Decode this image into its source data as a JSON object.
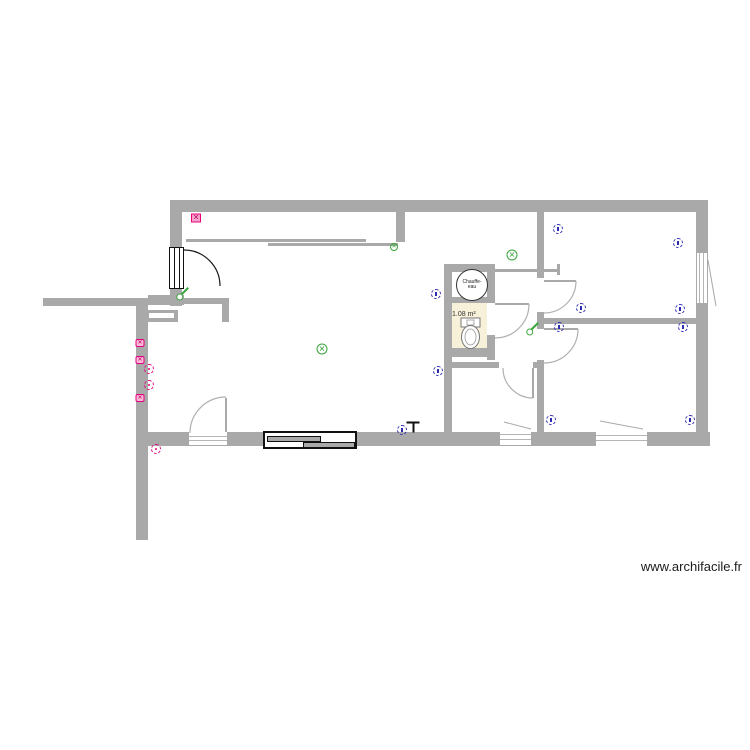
{
  "watermark": {
    "text": "www.archifacile.fr"
  },
  "labels": {
    "water_heater": "Chauffe-eau",
    "wc_area": "1.08 m²"
  },
  "colors": {
    "wall_gray": "#a9a9a9",
    "door_arc_gray": "#b0b0b0",
    "entry_door_black": "#111111",
    "outlet_pink": "#e5007d",
    "outlet_blue": "#2b2bb4",
    "light_green": "#3aa53a",
    "wc_floor_beige": "#f8f1da"
  },
  "symbols": [
    {
      "type": "socket-grid-pink",
      "x": 196,
      "y": 218
    },
    {
      "type": "outlet-pink",
      "x": 140,
      "y": 343
    },
    {
      "type": "outlet-pink",
      "x": 140,
      "y": 360
    },
    {
      "type": "outlet-pink-dashed",
      "x": 149,
      "y": 369
    },
    {
      "type": "outlet-pink-dashed",
      "x": 149,
      "y": 385
    },
    {
      "type": "outlet-pink",
      "x": 140,
      "y": 398
    },
    {
      "type": "outlet-pink-dashed",
      "x": 156,
      "y": 449
    },
    {
      "type": "outlet-blue",
      "x": 558,
      "y": 229
    },
    {
      "type": "outlet-blue",
      "x": 678,
      "y": 243
    },
    {
      "type": "outlet-blue",
      "x": 436,
      "y": 294
    },
    {
      "type": "outlet-blue",
      "x": 581,
      "y": 308
    },
    {
      "type": "outlet-blue",
      "x": 680,
      "y": 309
    },
    {
      "type": "outlet-blue",
      "x": 559,
      "y": 327
    },
    {
      "type": "outlet-blue",
      "x": 683,
      "y": 327
    },
    {
      "type": "outlet-blue",
      "x": 438,
      "y": 371
    },
    {
      "type": "outlet-blue",
      "x": 402,
      "y": 430
    },
    {
      "type": "outlet-blue",
      "x": 551,
      "y": 420
    },
    {
      "type": "outlet-blue",
      "x": 690,
      "y": 420
    },
    {
      "type": "light-green",
      "x": 322,
      "y": 349
    },
    {
      "type": "light-green",
      "x": 512,
      "y": 255
    },
    {
      "type": "light-green-small",
      "x": 394,
      "y": 247
    },
    {
      "type": "switch-green",
      "x": 184,
      "y": 292
    },
    {
      "type": "switch-green",
      "x": 534,
      "y": 327
    },
    {
      "type": "fixture-black",
      "x": 413,
      "y": 427
    }
  ]
}
